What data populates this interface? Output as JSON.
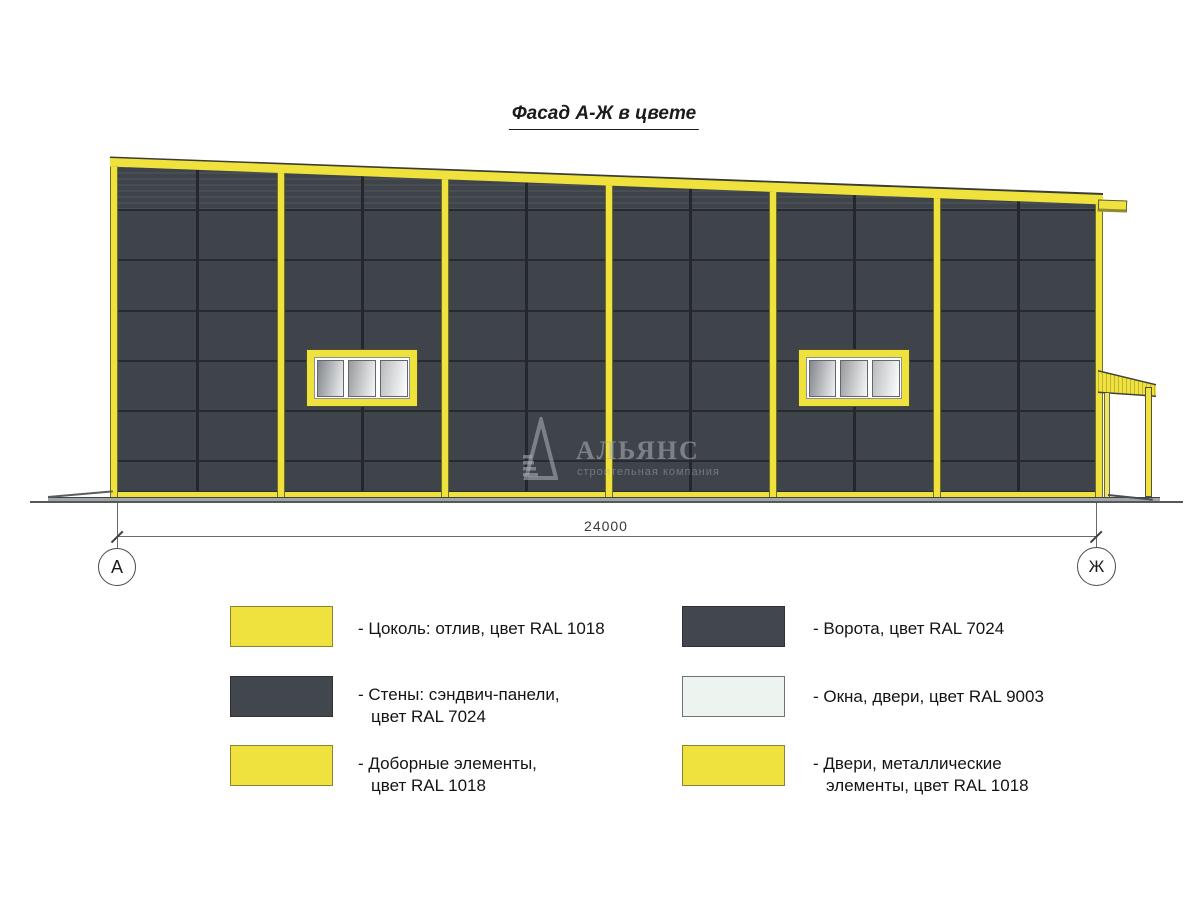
{
  "title": "Фасад А-Ж в цвете",
  "drawing": {
    "dimension_label": "24000",
    "axis_left": "А",
    "axis_right": "Ж",
    "watermark": {
      "name": "АЛЬЯНС",
      "subtitle": "строительная компания"
    }
  },
  "colors": {
    "ral1018_yellow": "#F0E23C",
    "ral7024_gray": "#3F444B",
    "ral9003_white": "#EDF3EE",
    "panel_joint": "#24272D",
    "ground": "#55585C"
  },
  "legend": {
    "items": [
      {
        "swatch": "yellow",
        "line1": "- Цоколь: отлив, цвет RAL 1018",
        "line2": ""
      },
      {
        "swatch": "dark",
        "line1": "- Стены: сэндвич-панели,",
        "line2": "цвет RAL 7024"
      },
      {
        "swatch": "yellow",
        "line1": "- Доборные элементы,",
        "line2": "цвет RAL 1018"
      },
      {
        "swatch": "dark",
        "line1": "- Ворота, цвет RAL 7024",
        "line2": ""
      },
      {
        "swatch": "white",
        "line1": "- Окна, двери, цвет RAL 9003",
        "line2": ""
      },
      {
        "swatch": "yellow",
        "line1": "- Двери, металлические",
        "line2": "элементы, цвет RAL 1018"
      }
    ]
  }
}
